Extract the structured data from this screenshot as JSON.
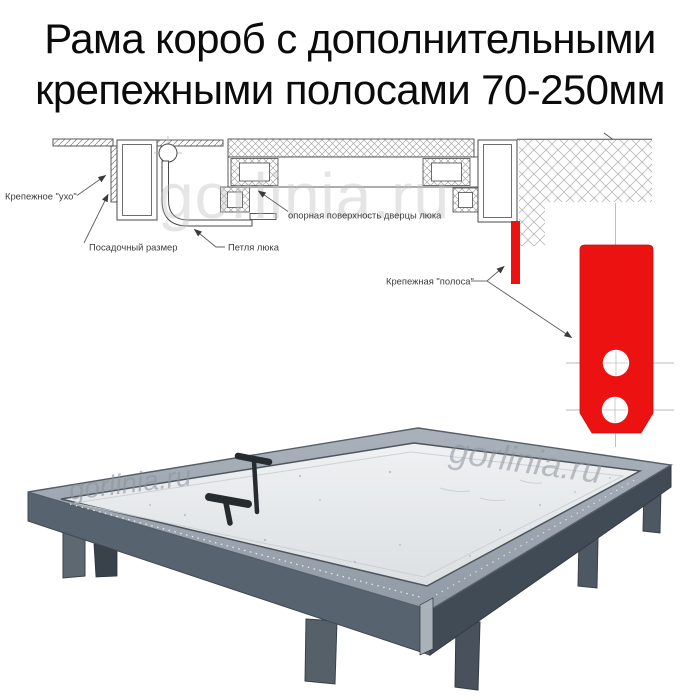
{
  "title": {
    "line1": "Рама короб с дополнительными",
    "line2": "крепежными полосами 70-250мм"
  },
  "watermark_text": "gorlinia.ru",
  "diagram": {
    "labels": {
      "ear": "Крепежное \"ухо\"",
      "mounting_size": "Посадочный размер",
      "hinge": "Петля люка",
      "support_surface": "опорная поверхность дверцы люка",
      "strip": "Крепежная \"полоса\""
    },
    "colors": {
      "accent_red": "#ed1212",
      "line": "#4a4a4a",
      "hatch": "#a8a8a8",
      "centerline": "#b9b9b9"
    }
  },
  "photo": {
    "colors": {
      "panel": "#e7eaec",
      "frame_lip": "#9aa3ad",
      "side_left": "#57636e",
      "side_right": "#414b55",
      "legs": "#535d67",
      "handles": "#262b30"
    }
  }
}
